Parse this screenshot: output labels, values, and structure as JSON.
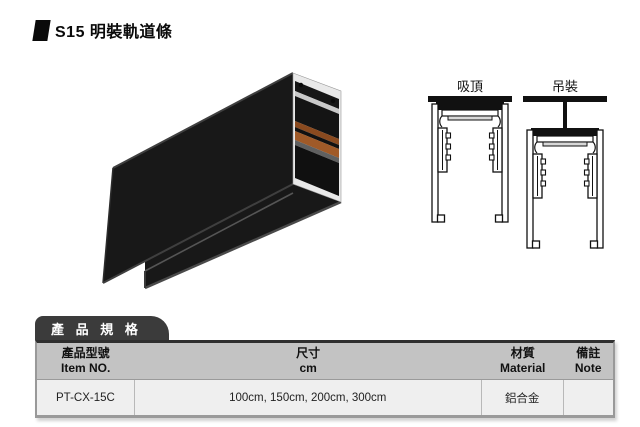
{
  "title": {
    "text": "S15 明裝軌道條"
  },
  "product_render": {
    "name": "surface-mounted-track-3d-render",
    "colors": {
      "body": "#1a1a1a",
      "edge_highlight": "#4a4a4a",
      "cut_face_aluminum": "#e9e9e9",
      "copper_strip_1": "#8a4a1f",
      "copper_strip_2": "#a05a28"
    }
  },
  "mount_diagrams": {
    "ceiling": {
      "label": "吸頂"
    },
    "suspended": {
      "label": "吊裝"
    },
    "line_color": "#111111"
  },
  "spec_table": {
    "tab_label": "產 品 規 格",
    "columns": [
      {
        "zh": "產品型號",
        "en": "Item NO."
      },
      {
        "zh": "尺寸",
        "en": "cm"
      },
      {
        "zh": "材質",
        "en": "Material"
      },
      {
        "zh": "備註",
        "en": "Note"
      }
    ],
    "rows": [
      {
        "item_no": "PT-CX-15C",
        "size": "100cm, 150cm, 200cm, 300cm",
        "material": "鋁合金",
        "note": ""
      }
    ],
    "colors": {
      "tab_bg": "#3b3b3b",
      "tab_text": "#ffffff",
      "header_bg": "#c3c3c3",
      "row_bg": "#efefef",
      "border": "#999999",
      "top_border": "#2f2f2f"
    }
  }
}
